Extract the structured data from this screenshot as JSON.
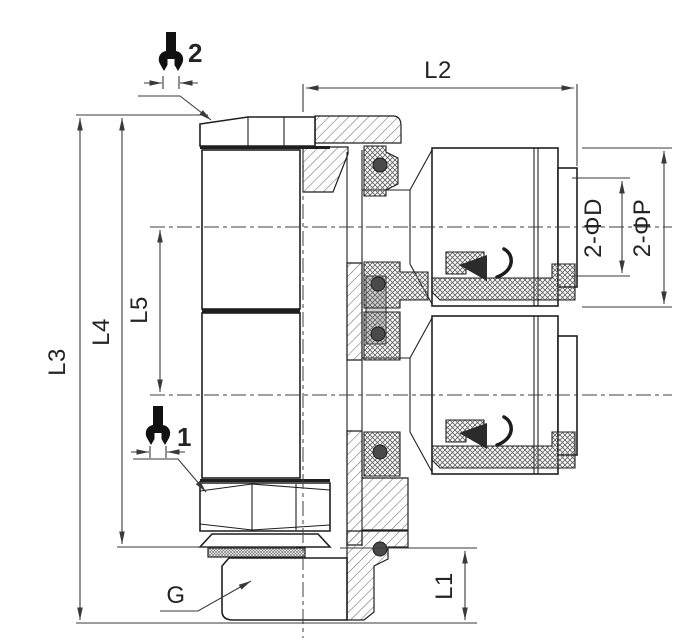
{
  "drawing": {
    "type": "technical-section-drawing",
    "subject": "double push-in pneumatic fitting, half-section view",
    "background": "#ffffff",
    "line_color": "#1f1f1f",
    "dim_color": "#3a3a3a",
    "labels": {
      "l1": "L1",
      "l2": "L2",
      "l3": "L3",
      "l4": "L4",
      "l5": "L5",
      "thread": "G",
      "bore_dia": "2-ΦD",
      "tube_dia": "2-ΦP"
    },
    "callouts": {
      "wrench_top": "2",
      "wrench_bottom": "1"
    }
  }
}
